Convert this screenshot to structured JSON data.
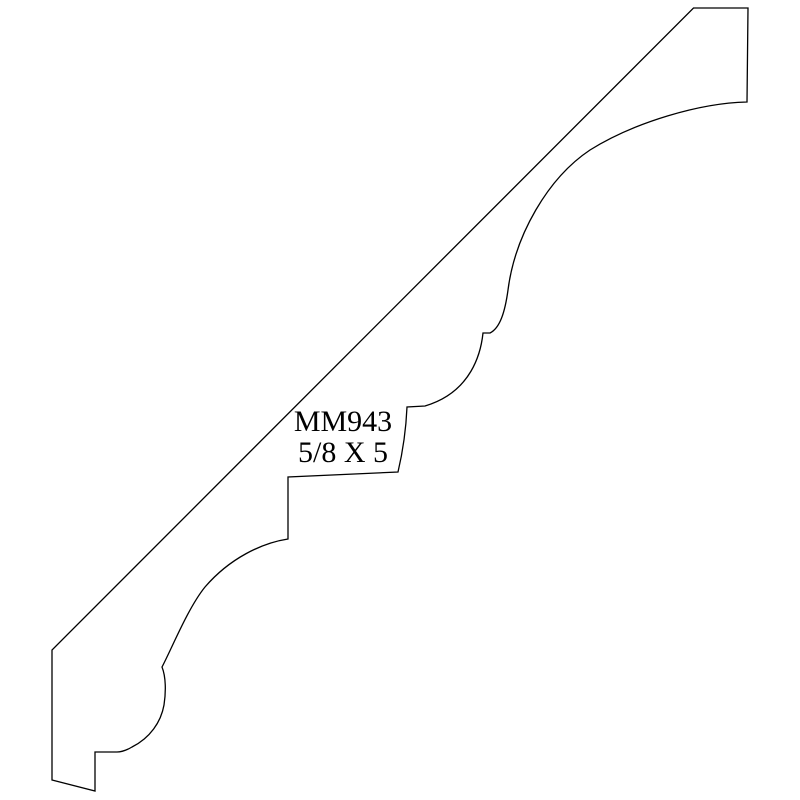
{
  "page": {
    "background_color": "#ffffff"
  },
  "drawing": {
    "part_number": "MM943",
    "dimensions": "5/8 X 5",
    "stroke_color": "#000000",
    "profile_path": "M 693.5 8 L 748 8 L 747 102 C 700 103 635 122 590 150 C 548 178 515 235 508 290 C 505 312 500 328 490 333 L 483 333 C 481 352 472 392 425 406 L 407 407 C 406 430 402 455 398 472 L 288 477 L 288 539 C 262 543 230 558 205 587 C 188 608 172 648 162 667 C 166 677 166 692 164 705 C 161 722 150 738 132 747 C 127 750 122 752 117 752 L 95 752 L 95 791 L 52 780 L 52 650 Z"
  }
}
